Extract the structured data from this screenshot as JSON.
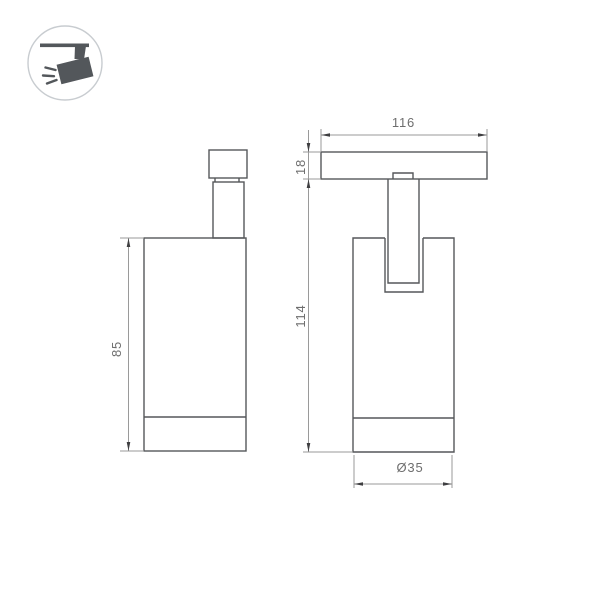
{
  "drawing": {
    "type": "technical-dimension-drawing",
    "subject": "track-mounted spotlight, two orthographic views"
  },
  "badge": {
    "icon": "track-spotlight-icon"
  },
  "dimensions": {
    "body_height": "85",
    "track_width": "116",
    "track_thickness": "18",
    "overall_height": "114",
    "diameter": "Ø35"
  },
  "colors": {
    "background": "#ffffff",
    "outline": "#55575a",
    "dimension_line": "#9a9a9a",
    "arrow": "#3f3f41",
    "dimension_text": "#6e6e6e",
    "badge_icon": "#53575b",
    "badge_ring": "#c8ccd0"
  }
}
